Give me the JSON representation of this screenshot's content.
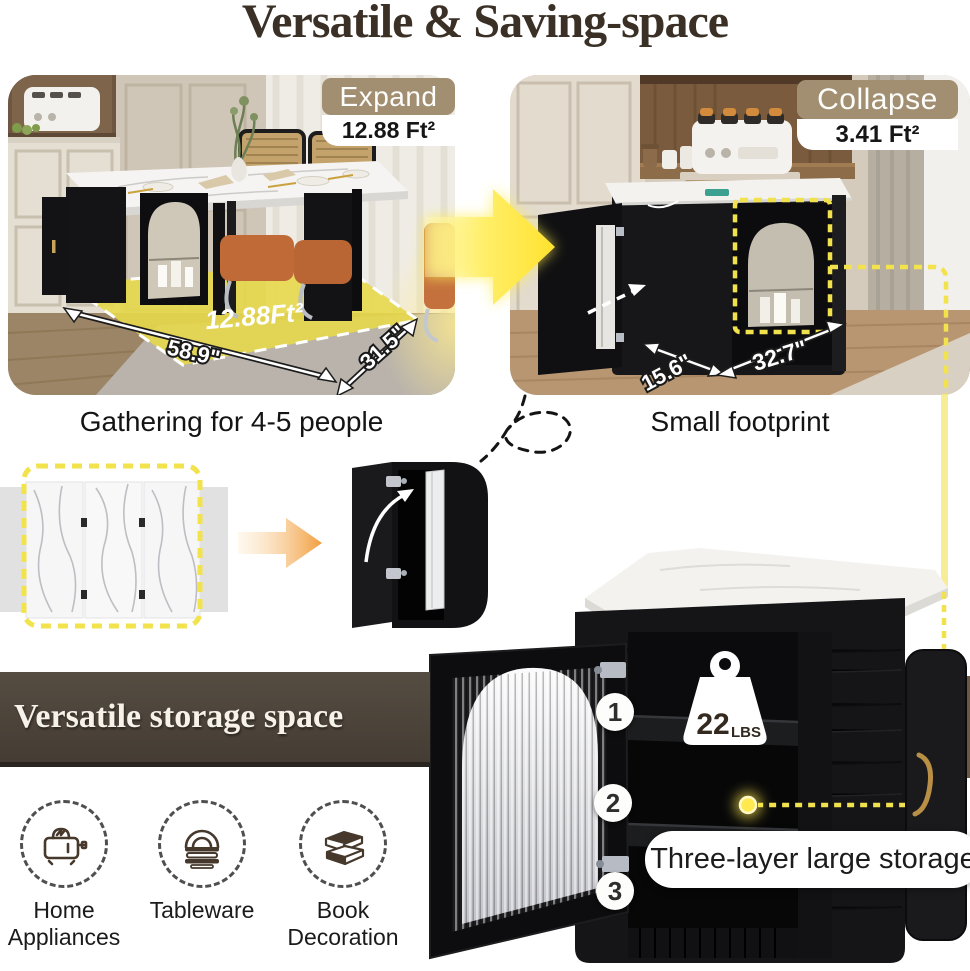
{
  "title": "Versatile & Saving-space",
  "panels": {
    "expand": {
      "badge": "Expand",
      "footprint": "12.88 Ft²",
      "floor_label": "12.88Ft²",
      "dim_width": "58.9\"",
      "dim_depth": "31.5\"",
      "caption": "Gathering for 4-5 people"
    },
    "collapse": {
      "badge": "Collapse",
      "footprint": "3.41 Ft²",
      "dim_depth": "15.6\"",
      "dim_width": "32.7\"",
      "caption": "Small footprint"
    }
  },
  "storage": {
    "banner": "Versatile storage space",
    "features": [
      {
        "label": "Home Appliances",
        "icon": "toaster-icon"
      },
      {
        "label": "Tableware",
        "icon": "tableware-icon"
      },
      {
        "label": "Book Decoration",
        "icon": "books-icon"
      }
    ],
    "layer_markers": [
      "1",
      "2",
      "3"
    ],
    "weight": {
      "value": "22",
      "unit": "LBS"
    },
    "callout": "Three-layer large storage"
  },
  "colors": {
    "accent_yellow": "#f2e24b",
    "badge_tan": "#a28f72",
    "banner_brown": "#4c443a",
    "title_brown": "#3a3026",
    "arrow_orange": "#f29d3e"
  }
}
